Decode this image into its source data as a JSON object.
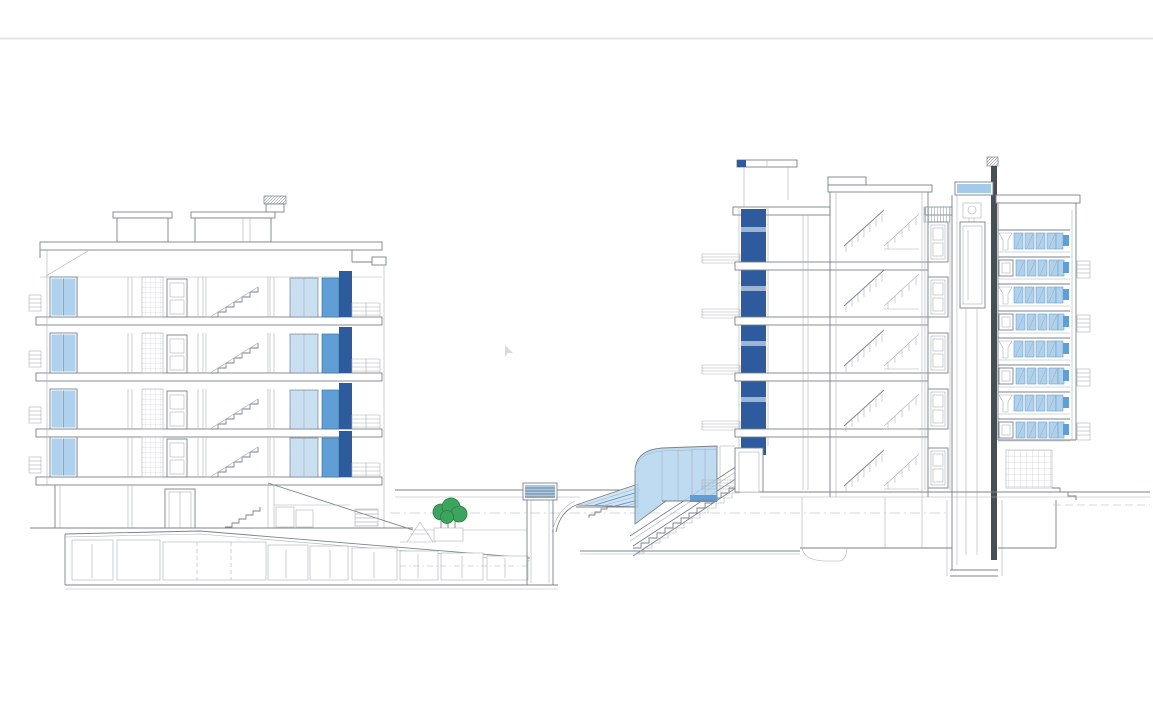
{
  "drawing": {
    "label": "Architectural cross-section drawing of two residential buildings with courtyard stair",
    "colors": {
      "line": "#7b828b",
      "line_faint": "#a9b0b8",
      "line_heavy": "#474e56",
      "page_rule": "#e4e4e4",
      "glass_light": "#aed2ee",
      "glass_lighter": "#c9dff2",
      "glass_mid": "#5f9fd6",
      "glass_dark": "#2e5b9e",
      "skylight_blue": "#a3cbe9",
      "tree_green": "#3ba55f",
      "tree_green_dark": "#2c7c46"
    },
    "left_building": {
      "floors": 4,
      "basement_rooms": 9
    },
    "right_building": {
      "floor_doors": 5,
      "window_rows": 8,
      "stair_levels": 5
    },
    "courtyard": {
      "trees": 3
    }
  }
}
